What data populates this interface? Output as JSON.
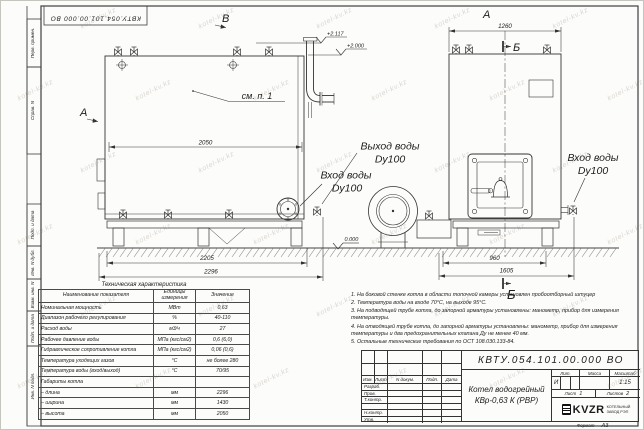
{
  "frame": {
    "top_stamp": "КВТУ.054.101.00.000 ВО",
    "side_stamps": [
      "Перв. примен.",
      "Справ. N",
      "Подп. и дата",
      "Инв. N дубл.",
      "Взам. инв. N",
      "Подп. и дата",
      "Инв. N подл."
    ]
  },
  "watermark": {
    "text": "kotel-kv.kz"
  },
  "drawing": {
    "views": {
      "top_view": "В",
      "side_arrow": "А",
      "front_view": "А",
      "section_top": "Б",
      "section_bottom": "Б"
    },
    "note_ref": "см. п. 1",
    "elevations": {
      "stack_top": "+2.117",
      "boiler_top": "+2.000",
      "ground": "0.000"
    },
    "ports": {
      "outlet_title": "Выход воды",
      "outlet_dn": "Dy100",
      "inlet_title": "Вход воды",
      "inlet_dn": "Dy100",
      "inlet_front_title": "Вход воды",
      "inlet_front_dn": "Dy100"
    },
    "dimensions": {
      "side_top": "2050",
      "side_frame": "2205",
      "side_overall": "2296",
      "front_top": "1260",
      "front_frame": "960",
      "front_overall": "1605"
    }
  },
  "spec_table": {
    "title": "Техническая характеристика",
    "headers": [
      "Наименование показателя",
      "Единицы измерения",
      "Значение"
    ],
    "rows": [
      [
        "Номинальная мощность",
        "МВт",
        "0,63"
      ],
      [
        "Диапазон рабочего регулирования",
        "%",
        "40-110"
      ],
      [
        "Расход воды",
        "м3/ч",
        "27"
      ],
      [
        "Рабочее давление воды",
        "МПа (кгс/см2)",
        "0,6 (6,0)"
      ],
      [
        "Гидравлическое сопротивление котла",
        "МПа (кгс/см2)",
        "0,06 (0,6)"
      ],
      [
        "Температура уходящих газов",
        "°С",
        "не более 280"
      ],
      [
        "Температура воды (вход/выход)",
        "°С",
        "70/95"
      ],
      [
        "Габариты котла",
        "",
        ""
      ],
      [
        "– длина",
        "мм",
        "2296"
      ],
      [
        "– ширина",
        "мм",
        "1430"
      ],
      [
        "– высота",
        "мм",
        "2050"
      ]
    ]
  },
  "notes": [
    "1. На боковой стенке котла в области топочной камеры установлен пробоотборный штуцер",
    "2. Температура воды на входе 70°С, на выходе 95°С.",
    "3. На подводящей трубе котла, до запорной арматуры установлены: манометр, прибор для измерения температуры.",
    "4. На отводящей трубе котла, до запорной арматуры установлены: манометр, прибор для измерения температуры и два предохранительных клапана Ду не менее 40 мм.",
    "5. Остальные технические требования по ОСТ 108.030.133-84."
  ],
  "title_block": {
    "doc_number": "КВТУ.054.101.00.000 ВО",
    "product_title_line1": "Котел водогрейный",
    "product_title_line2": "КВр-0,63 К (РВР)",
    "rev_headers": [
      "Изм.",
      "Лист",
      "N докум.",
      "Подп.",
      "Дата"
    ],
    "sign_rows": [
      "Разраб.",
      "Пров.",
      "Т.контр.",
      "",
      "Н.контр.",
      "Утв."
    ],
    "lit_label": "Лит.",
    "lit_value": "И",
    "mass_label": "Масса",
    "mass_value": "",
    "scale_label": "Масштаб",
    "scale_value": "1:15",
    "sheet_label": "Лист",
    "sheet_value": "1",
    "sheets_label": "Листов",
    "sheets_value": "2",
    "logo_text": "KVZR",
    "logo_caption_line1": "КОТЕЛЬНЫЙ",
    "logo_caption_line2": "ЗАВОД РЭП",
    "format_label": "Формат",
    "format_value": "А3"
  }
}
